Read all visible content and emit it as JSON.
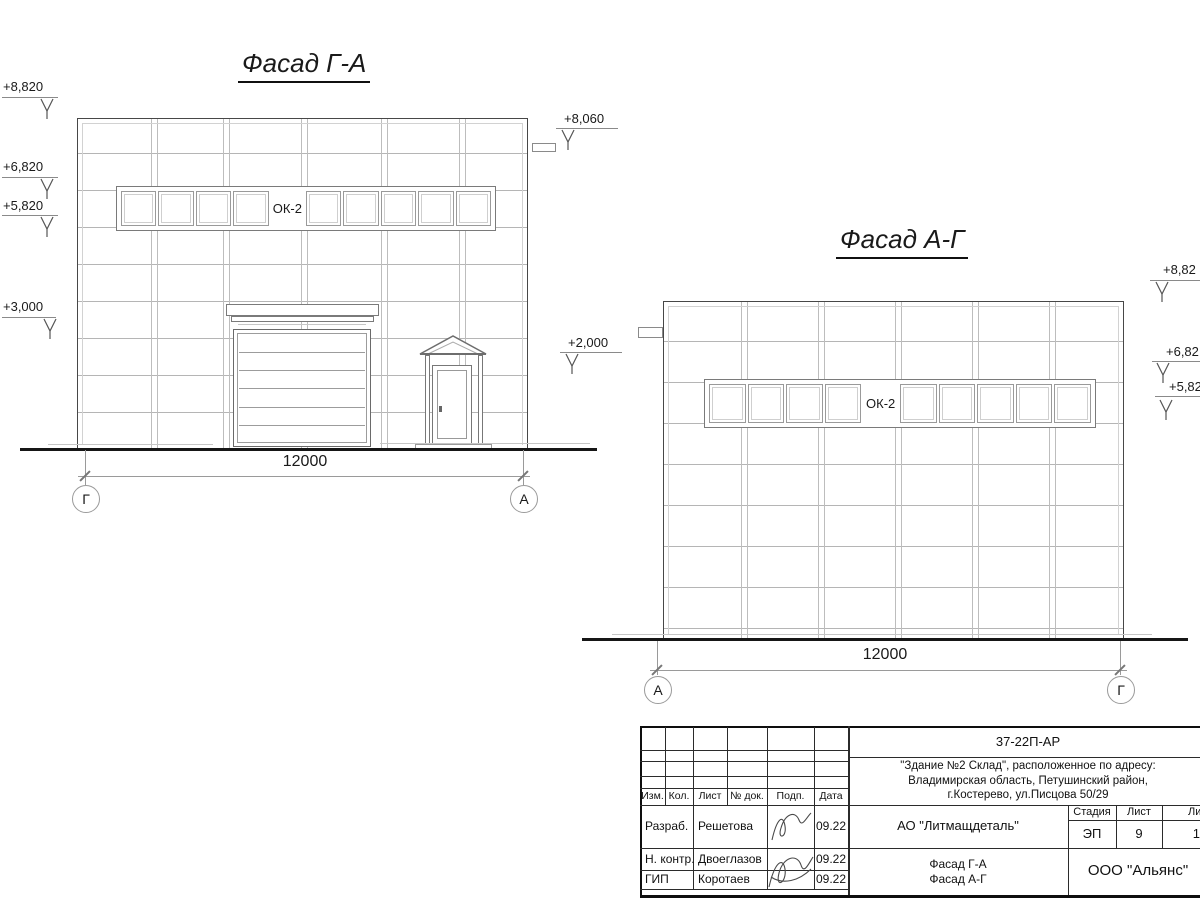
{
  "facade_ga": {
    "title": "Фасад Г-А",
    "window_label": "ОК-2",
    "dimension": "12000",
    "axis_left": "Г",
    "axis_right": "А",
    "elevations": [
      "+8,820",
      "+6,820",
      "+5,820",
      "+3,000",
      "+8,060",
      "+2,000"
    ]
  },
  "facade_ag": {
    "title": "Фасад А-Г",
    "window_label": "ОК-2",
    "dimension": "12000",
    "axis_left": "А",
    "axis_right": "Г",
    "elevations": [
      "+8,82",
      "+6,82",
      "+5,82"
    ]
  },
  "title_block": {
    "doc_number": "37-22П-АР",
    "address_line1": "\"Здание №2 Склад\", расположенное по адресу:",
    "address_line2": "Владимирская область, Петушинский район,",
    "address_line3": "г.Костерево, ул.Писцова 50/29",
    "col_izm": "Изм.",
    "col_kol": "Кол.",
    "col_list": "Лист",
    "col_dok": "№ док.",
    "col_podp": "Подп.",
    "col_data": "Дата",
    "row1_role": "Разраб.",
    "row1_name": "Решетова",
    "row1_date": "09.22",
    "row2_role": "Н. контр.",
    "row2_name": "Двоеглазов",
    "row2_date": "09.22",
    "row3_role": "ГИП",
    "row3_name": "Коротаев",
    "row3_date": "09.22",
    "company": "АО \"Литмащдеталь\"",
    "stage_label": "Стадия",
    "stage_value": "ЭП",
    "sheet_label": "Лист",
    "sheet_value": "9",
    "sheets_label": "Лист",
    "sheets_value": "14",
    "title_line1": "Фасад Г-А",
    "title_line2": "Фасад А-Г",
    "org": "ООО \"Альянс\""
  }
}
